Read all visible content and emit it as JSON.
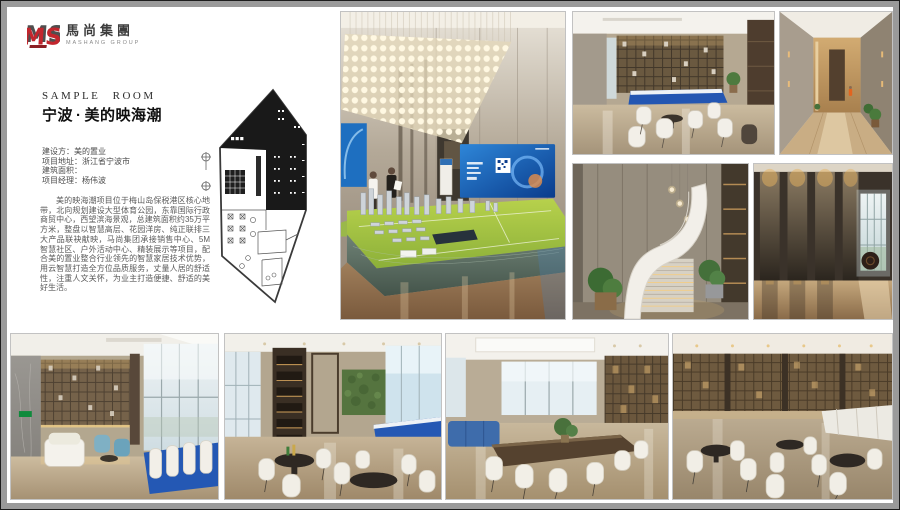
{
  "colors": {
    "brand_red": "#c2262d",
    "frame_gray": "#9a9a9a",
    "screen_blue": "#1668c4",
    "banquet_blue": "#2458b4"
  },
  "brand": {
    "monogram": "MS",
    "name_cn": "馬尚集團",
    "name_en": "MASHANG GROUP"
  },
  "header": {
    "eyebrow": "SAMPLE ROOM",
    "city": "宁波",
    "separator": "·",
    "project": "美的映海潮"
  },
  "details": [
    {
      "label": "建设方：",
      "value": "美的置业"
    },
    {
      "label": "项目地址：",
      "value": "浙江省宁波市"
    },
    {
      "label": "建筑面积：",
      "value": ""
    },
    {
      "label": "项目经理：",
      "value": "杨伟波"
    }
  ],
  "description": "美的映海潮项目位于梅山岛保税港区核心地带，北向规划建设大型体育公园，东靠国际行政商贸中心，西望滨海景观，总建筑面积约35万平方米，整盘以智慧高层、花园洋房、纯正联排三大产品联袂献映，马尚集团承接销售中心、5M智慧社区、户外活动中心、精装展示等项目，配合美的置业整合行业领先的智慧家居技术优势，用云智慧打造全方位品质服务，丈量人居的舒适性，注重人文关怀，为业主打造便捷、舒适的美好生活。"
}
